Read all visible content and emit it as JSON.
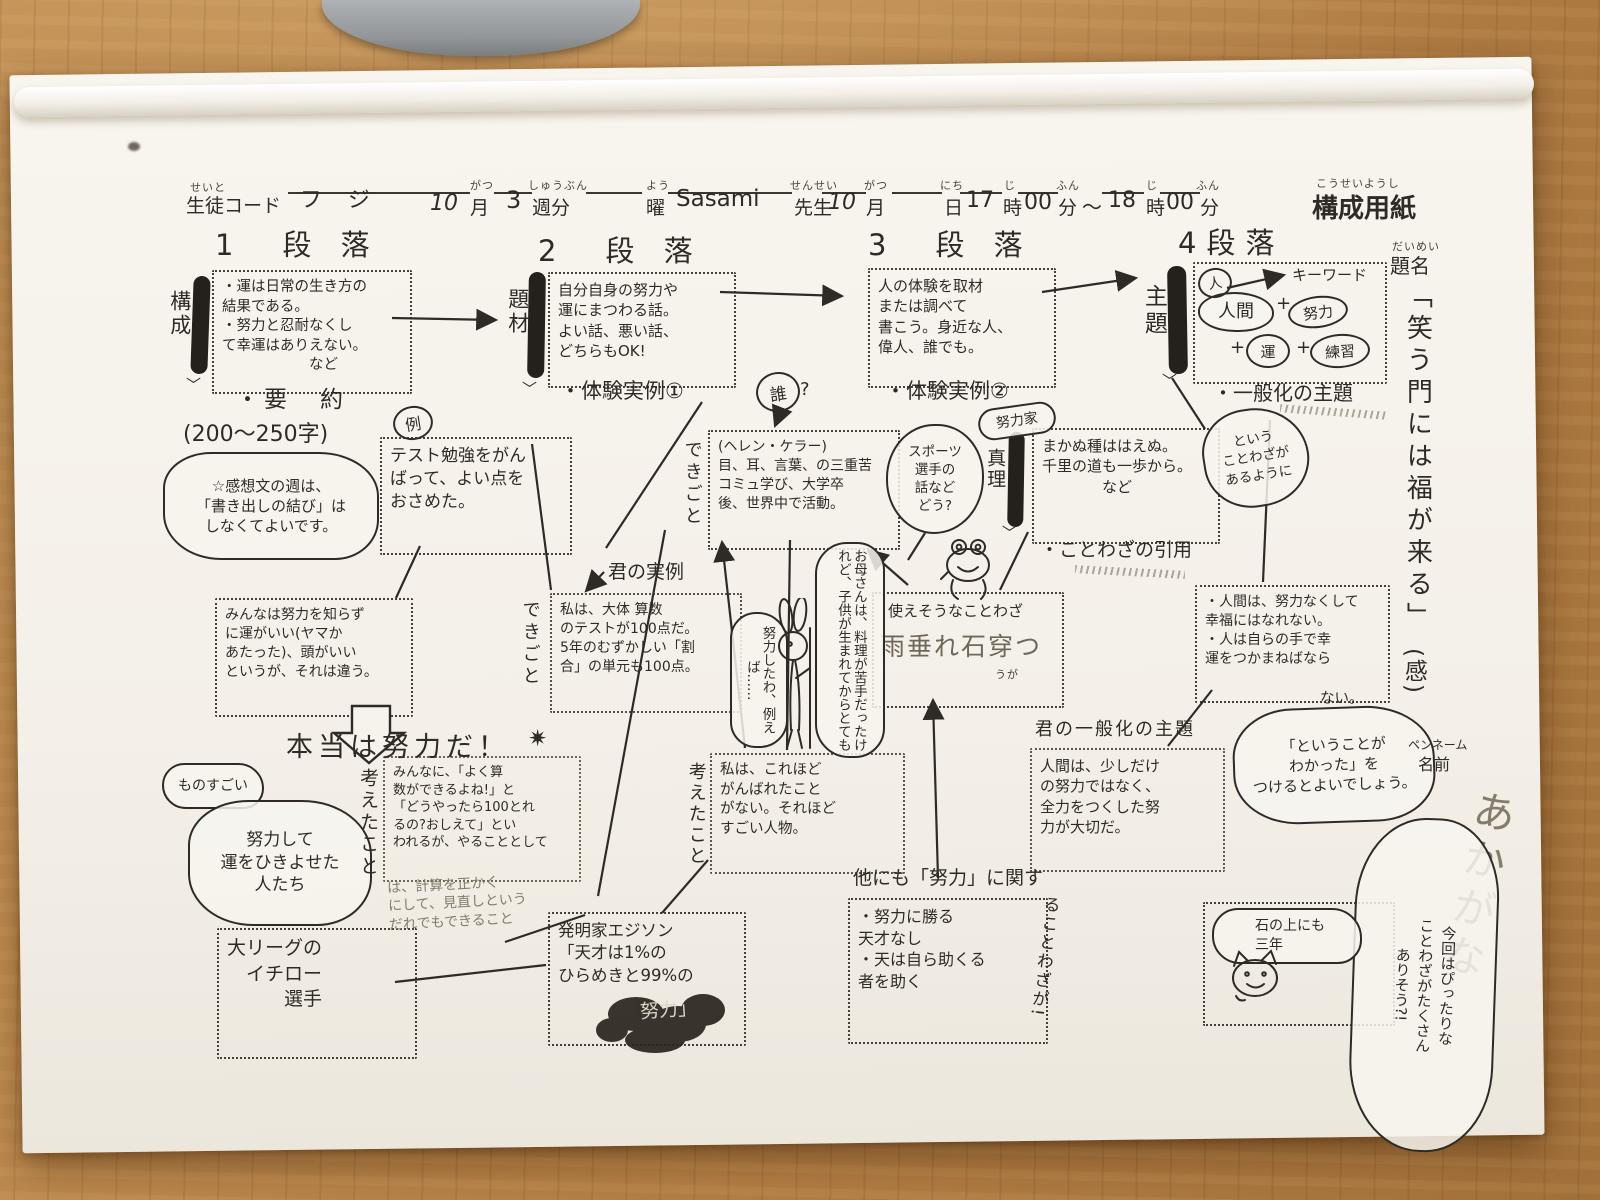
{
  "header": {
    "student_furi": "せいと",
    "student_label": "生徒コード",
    "student_value": "フジ",
    "month1_value": "10",
    "month1_furi": "がつ",
    "month1_label": "月",
    "week_value": "3",
    "week_furi": "しゅうぶん",
    "week_label": "週分",
    "youbi_furi": "よう",
    "youbi_label": "曜",
    "teacher_value": "Sasami",
    "teacher_furi": "せんせい",
    "teacher_label": "先生",
    "month2_value": "10",
    "month2_furi": "がつ",
    "month2_label": "月",
    "day_furi": "にち",
    "day_label": "日",
    "start_hour": "17",
    "hour1_furi": "じ",
    "hour1_label": "時",
    "start_min": "00",
    "min1_furi": "ふん",
    "min1_label": "分",
    "tilde": "〜",
    "end_hour": "18",
    "hour2_furi": "じ",
    "hour2_label": "時",
    "end_min": "00",
    "min2_furi": "ふん",
    "min2_label": "分",
    "sheet_furi": "こうせいようし",
    "sheet_title": "構成用紙"
  },
  "p1": {
    "heading": "1　段 落",
    "side_label": "構成",
    "main_box": "・運は日常の生き方の\n結果である。\n・努力と忍耐なくし\nて幸運はありえない。\n　　　　　　など",
    "summary": "・要　約",
    "count": "(200〜250字)",
    "note": "☆感想文の週は、\n「書き出しの結び」は\nしなくてよいです。",
    "example_mark": "例",
    "example_box": "テスト勉強をがん\nばって、よい点を\nおさめた。",
    "minna_box": "みんなは努力を知らず\nに運がいい(ヤマか\nあたった)、頭がいい\nというが、それは違う。",
    "hontou": "本当は努力だ！",
    "star": "✷",
    "monosugoi": "ものすごい",
    "hikiyose": "努力して\n運をひきよせた\n人たち",
    "kangaeta": "考えたこと",
    "ichiro_box": "大リーグの\n　イチロー\n　　　選手",
    "sansu_box": "みんなに、「よく算\n数ができるよね!」と\n「どうやったら100とれ\nるの?おしえて」とい\nわれるが、やることとして",
    "sansu_more": "は、計算を正かく\nにして、見直しという\nだれでもできること"
  },
  "p2": {
    "heading": "2　段 落",
    "side_label": "題材",
    "main_box": "自分自身の努力や\n運にまつわる話。\nよい話、悪い話、\nどちらもOK!",
    "taiken": "・体験実例①",
    "kimi_jitsurei": "君の実例",
    "jitsurei_box": "私は、大体 算数\nのテストが100点だ。\n5年のむずかしい「割\n合」の単元も100点。",
    "dekigoto": "できごと",
    "edison_box": "発明家エジソン\n「天才は1%の\nひらめきと99%の",
    "edison_last": "努力」"
  },
  "p3": {
    "heading": "3　段 落",
    "main_box": "人の体験を取材\nまたは調べて\n書こう。身近な人、\n偉人、誰でも。",
    "taiken": "・体験実例②",
    "dare": "誰",
    "dare_q": "?",
    "dekigoto": "できごと",
    "helen_box": "(ヘレン・ケラー)\n目、耳、言葉、の三重苦\nコミュ学び、大学卒\n後、世界中で活動。",
    "sports_bubble": "スポーツ\n選手の\n話など\nどう?",
    "doryokuka": "努力家",
    "side_label": "真理",
    "makanu_box": "まかぬ種ははえぬ。\n千里の道も一歩から。\n　　　　など",
    "inyou": "・ことわざの引用",
    "tsukaesou_title": "使えそうなことわざ",
    "tsukaesou_kotowaza": "雨垂れ石穿つ",
    "tsukaesou_furi": "うが",
    "bubble_doryoku": "努力したわ、例えば……",
    "bubble_okasan": "お母さんは、料理が苦手だったけれど、子供が生まれてからとても",
    "ganbatta_box": "私は、これほど\nがんばれたこと\nがない。それほど\nすごい人物。",
    "kangaeta": "考えたこと",
    "hokanimo": "他にも「努力」に関す",
    "hoka_box": "・努力に勝る\n天才なし\n・天は自ら助くる\n者を助く",
    "hoka_vert": "ることわざが!"
  },
  "p4": {
    "heading": "4段落",
    "side_label": "主題",
    "hito": "人",
    "keyword": "キーワード",
    "ningen": "人間",
    "plus1": "+",
    "doryoku": "努力",
    "plus2": "+",
    "un": "運",
    "plus3": "+",
    "renshu": "練習",
    "ippanka": "・一般化の主題",
    "toiu_bubble": "という\nことわざが\nあるように",
    "ningen_box": "・人間は、努力なくして\n幸福にはなれない。\n・人は自らの手で幸\n運をつかまねばなら",
    "ningen_box_tail": "ない。",
    "kimi_ippanka": "君の一般化の主題",
    "ippanka_box": "人間は、少しだけ\nの努力ではなく、\n全力をつくした努\n力が大切だ。",
    "wakatta_cloud": "「ということが\nわかった」を\nつけるとよいでしょう。",
    "penname_label": "ペンネーム",
    "name_label": "名前",
    "penname_value": "あかがな",
    "kondo_cloud": "今回はぴったりな\nことわざがたくさん\nありそう?!",
    "ishi_bubble": "石の上にも\n三年"
  },
  "title": {
    "daimei_furi": "だいめい",
    "daimei": "題名",
    "text": "「笑う門には福が来る」",
    "kan": "(感)"
  }
}
